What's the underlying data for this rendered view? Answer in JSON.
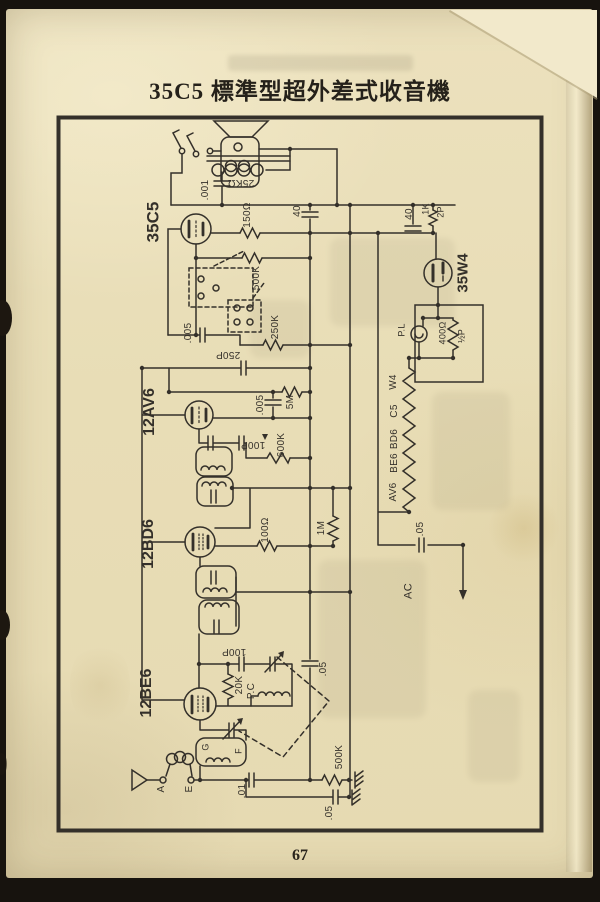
{
  "page": {
    "title": "35C5 標準型超外差式收音機",
    "page_number": "67"
  },
  "colors": {
    "paper": "#e8ddb6",
    "ink": "#34302a",
    "photo_background": "#17130e",
    "fold": "#f2e9cb"
  },
  "schematic": {
    "description_labels": {
      "tubes": [
        "35C5",
        "12AV6",
        "12BD6",
        "12BE6",
        "35W4"
      ],
      "terminals": [
        "A",
        "E",
        "G",
        "F"
      ],
      "power": [
        "AC",
        "P.L"
      ]
    },
    "labels": [
      {
        "t": "35C5",
        "x": 153,
        "y": 222,
        "s": 17,
        "b": 1
      },
      {
        "t": "12AV6",
        "x": 150,
        "y": 412,
        "s": 16,
        "b": 1
      },
      {
        "t": "12BD6",
        "x": 149,
        "y": 544,
        "s": 16,
        "b": 1
      },
      {
        "t": "12BE6",
        "x": 147,
        "y": 693,
        "s": 16,
        "b": 1
      },
      {
        "t": "35W4",
        "x": 463,
        "y": 273,
        "s": 15,
        "b": 1
      },
      {
        "t": ".001",
        "x": 206,
        "y": 190,
        "s": 10
      },
      {
        "t": "25KΩ",
        "x": 241,
        "y": 182,
        "s": 10,
        "r": 180
      },
      {
        "t": "150Ω",
        "x": 248,
        "y": 215,
        "s": 10
      },
      {
        "t": "40",
        "x": 298,
        "y": 211,
        "s": 10
      },
      {
        "t": "40",
        "x": 410,
        "y": 214,
        "s": 10
      },
      {
        "t": "1K",
        "x": 426,
        "y": 209,
        "s": 9
      },
      {
        "t": "2P",
        "x": 441,
        "y": 212,
        "s": 9
      },
      {
        "t": "500K",
        "x": 257,
        "y": 278,
        "s": 10
      },
      {
        "t": "250K",
        "x": 276,
        "y": 327,
        "s": 10
      },
      {
        "t": ".005",
        "x": 189,
        "y": 333,
        "s": 10
      },
      {
        "t": "250P",
        "x": 228,
        "y": 354,
        "s": 10,
        "r": 180
      },
      {
        "t": "5M",
        "x": 291,
        "y": 402,
        "s": 10
      },
      {
        "t": ".005",
        "x": 261,
        "y": 405,
        "s": 10
      },
      {
        "t": "100P",
        "x": 253,
        "y": 444,
        "s": 10,
        "r": 180
      },
      {
        "t": "600K",
        "x": 282,
        "y": 445,
        "s": 10
      },
      {
        "t": "100Ω",
        "x": 266,
        "y": 530,
        "s": 10
      },
      {
        "t": "1M",
        "x": 322,
        "y": 528,
        "s": 10
      },
      {
        "t": "P.L",
        "x": 402,
        "y": 330,
        "s": 9
      },
      {
        "t": "400Ω",
        "x": 443,
        "y": 333,
        "s": 9
      },
      {
        "t": "½P",
        "x": 462,
        "y": 336,
        "s": 9
      },
      {
        "t": "W4",
        "x": 394,
        "y": 382,
        "s": 10
      },
      {
        "t": "C5",
        "x": 395,
        "y": 411,
        "s": 10
      },
      {
        "t": "BD6",
        "x": 395,
        "y": 439,
        "s": 10
      },
      {
        "t": "BE6",
        "x": 395,
        "y": 463,
        "s": 10
      },
      {
        "t": "AV6",
        "x": 394,
        "y": 492,
        "s": 10
      },
      {
        "t": ".05",
        "x": 421,
        "y": 529,
        "s": 10
      },
      {
        "t": "AC",
        "x": 409,
        "y": 591,
        "s": 11
      },
      {
        "t": "100P",
        "x": 234,
        "y": 651,
        "s": 10,
        "r": 180
      },
      {
        "t": "20K",
        "x": 240,
        "y": 685,
        "s": 10
      },
      {
        "t": "P.C",
        "x": 252,
        "y": 691,
        "s": 10
      },
      {
        "t": ".05",
        "x": 324,
        "y": 669,
        "s": 10
      },
      {
        "t": "G",
        "x": 206,
        "y": 747,
        "s": 9
      },
      {
        "t": "F",
        "x": 239,
        "y": 751,
        "s": 9
      },
      {
        "t": "A",
        "x": 162,
        "y": 789,
        "s": 10
      },
      {
        "t": "E",
        "x": 190,
        "y": 789,
        "s": 10
      },
      {
        "t": ".01",
        "x": 243,
        "y": 791,
        "s": 10
      },
      {
        "t": "500K",
        "x": 340,
        "y": 757,
        "s": 10
      },
      {
        "t": ".05",
        "x": 330,
        "y": 813,
        "s": 10
      }
    ]
  }
}
